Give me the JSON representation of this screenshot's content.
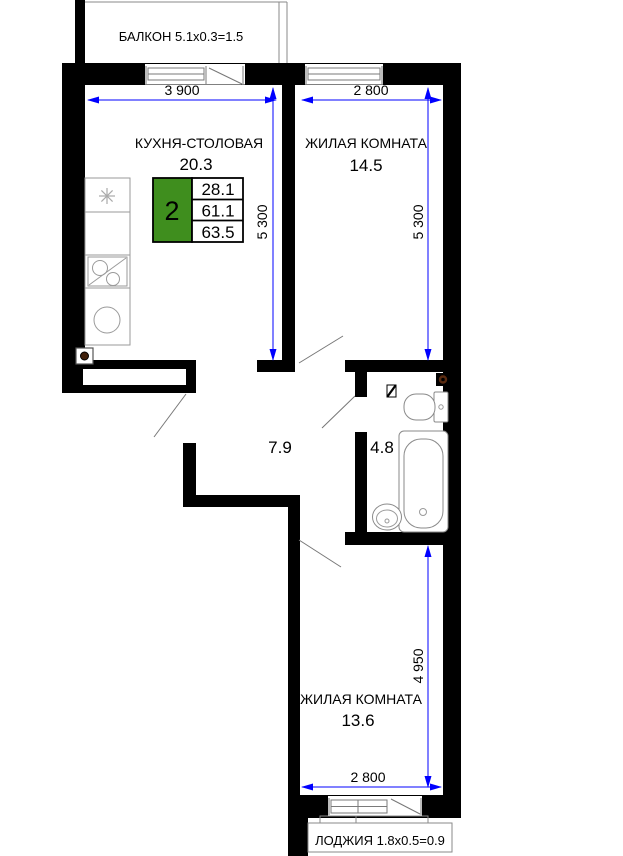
{
  "floor_plan": {
    "balcony": {
      "label": "БАЛКОН 5.1x0.3=1.5"
    },
    "loggia": {
      "label": "ЛОДЖИЯ 1.8x0.5=0.9"
    },
    "rooms": {
      "kitchen": {
        "name": "КУХНЯ-СТОЛОВАЯ",
        "area": "20.3"
      },
      "living_room_top": {
        "name": "ЖИЛАЯ КОМНАТА",
        "area": "14.5"
      },
      "living_room_bottom": {
        "name": "ЖИЛАЯ КОМНАТА",
        "area": "13.6"
      },
      "hallway": {
        "area": "7.9"
      },
      "bathroom": {
        "area": "4.8"
      }
    },
    "apartment_badge": {
      "room_count": "2",
      "living_area": "28.1",
      "area_without_balcony": "61.1",
      "total_area": "63.5"
    },
    "dimensions": {
      "kitchen_width": "3 900",
      "kitchen_depth": "5 300",
      "living_top_width": "2 800",
      "living_top_depth": "5 300",
      "living_bottom_depth": "4 950",
      "living_bottom_width": "2 800"
    },
    "colors": {
      "badge_green": "#3f8e1e",
      "dimension_blue": "#0000ff",
      "wall_black": "#000000"
    }
  }
}
